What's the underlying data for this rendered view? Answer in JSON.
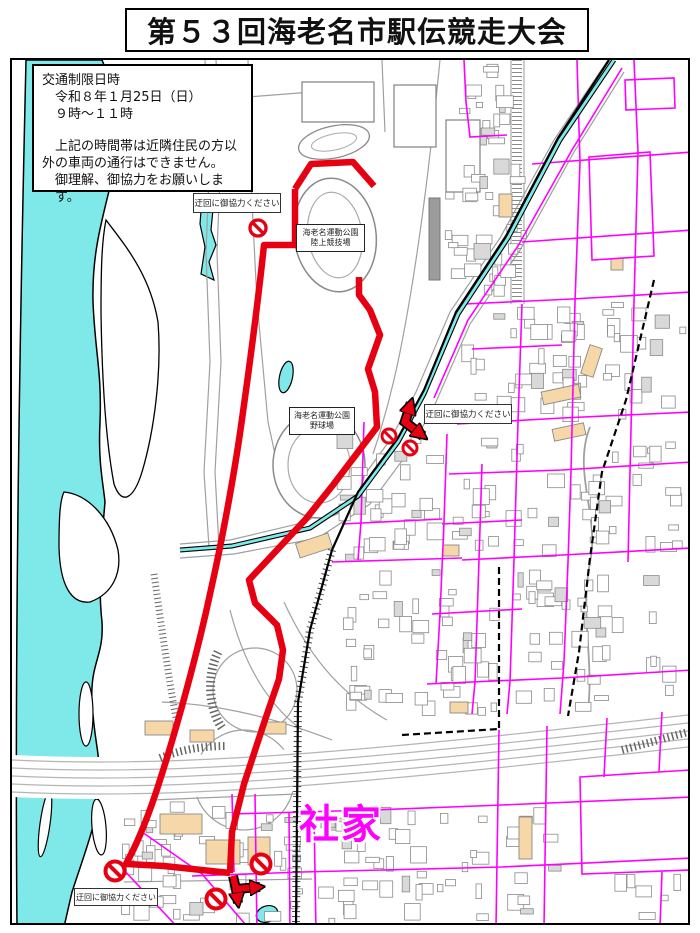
{
  "title": "第５３回海老名市駅伝競走大会",
  "notice": {
    "heading": "交通制限日時",
    "line1": "令和８年１月25日（日）",
    "line2": "９時～１１時",
    "para1": "上記の時間帯は近隣住民の方以",
    "para2": "外の車両の通行はできません。",
    "para3": "御理解、御協力をお願いします。"
  },
  "map": {
    "detour_label": "迂回に御協力ください",
    "stadium_label": {
      "line1": "海老名運動公園",
      "line2": "陸上競技場"
    },
    "baseball_label": {
      "line1": "海老名運動公園",
      "line2": "野球場"
    },
    "area_name": "社家",
    "no_entry_signs": [
      {
        "x": 256,
        "y": 226,
        "r": 8
      },
      {
        "x": 387,
        "y": 434,
        "r": 7
      },
      {
        "x": 408,
        "y": 446,
        "r": 7
      },
      {
        "x": 113,
        "y": 869,
        "r": 9.5
      },
      {
        "x": 259,
        "y": 862,
        "r": 9.5
      },
      {
        "x": 214,
        "y": 897,
        "r": 9.5
      }
    ],
    "colors": {
      "route_red": "#e60012",
      "water_cyan": "#7fe9e9",
      "road_magenta": "#ff00ff",
      "building_tan": "#f5d7a8",
      "area_label": "#ff00ff"
    }
  }
}
